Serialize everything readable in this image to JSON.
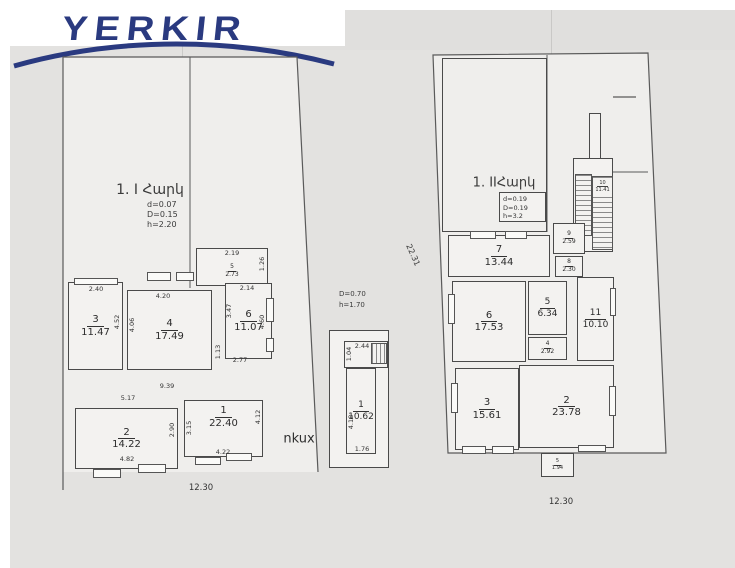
{
  "logo": {
    "text": "YERKIR",
    "color": "#2a3a80"
  },
  "floor1": {
    "title": "1. I Հարկ",
    "params": {
      "d": "d=0.07",
      "D": "D=0.15",
      "h": "h=2.20"
    },
    "rooms": {
      "r1": {
        "num": "1",
        "area": "22.40"
      },
      "r2": {
        "num": "2",
        "area": "14.22"
      },
      "r3": {
        "num": "3",
        "area": "11.47"
      },
      "r4": {
        "num": "4",
        "area": "17.49"
      },
      "r5": {
        "num": "5",
        "area": "2.73"
      },
      "r6": {
        "num": "6",
        "area": "11.07"
      }
    },
    "dims": {
      "r5_top": "2.19",
      "r5_right": "1.26",
      "r3_top": "2.40",
      "r3_right": "4.52",
      "r4_top": "4.20",
      "r4_left": "4.06",
      "r6_top": "2.14",
      "r6_left": "3.47",
      "r6_right": "4.60",
      "corridor": "1.13",
      "r6_bottom": "2.77",
      "mid_width": "9.39",
      "r2_top": "5.17",
      "r2_right": "2.90",
      "r2_bottom": "4.82",
      "r1_left": "3.15",
      "r1_right": "4.12",
      "r1_bottom": "4.22",
      "total_width": "12.30"
    }
  },
  "basement": {
    "label": "nkux",
    "params": {
      "D": "D=0.70",
      "h": "h=1.70"
    },
    "room": {
      "num": "1",
      "area": "10.62"
    },
    "dims": {
      "top": "2.44",
      "notch": "1.04",
      "left": "4.18",
      "bottom": "1.76"
    }
  },
  "floor2": {
    "title": "1. IIՀարկ",
    "params": {
      "d": "d=0.19",
      "D": "D=0.19",
      "h": "h=3.2"
    },
    "rooms": {
      "r2": {
        "num": "2",
        "area": "23.78"
      },
      "r3": {
        "num": "3",
        "area": "15.61"
      },
      "r4": {
        "num": "4",
        "area": "2.92"
      },
      "r5": {
        "num": "5",
        "area": "6.34"
      },
      "r6": {
        "num": "6",
        "area": "17.53"
      },
      "r7": {
        "num": "7",
        "area": "13.44"
      },
      "r8": {
        "num": "8",
        "area": "2.30"
      },
      "r9": {
        "num": "9",
        "area": "2.59"
      },
      "r10": {
        "num": "10",
        "area": "11.41"
      },
      "r11": {
        "num": "11",
        "area": "10.10"
      },
      "balcony": {
        "num": "5",
        "area": "1.94"
      }
    },
    "dims": {
      "total_height": "22.31",
      "total_width": "12.30"
    }
  }
}
